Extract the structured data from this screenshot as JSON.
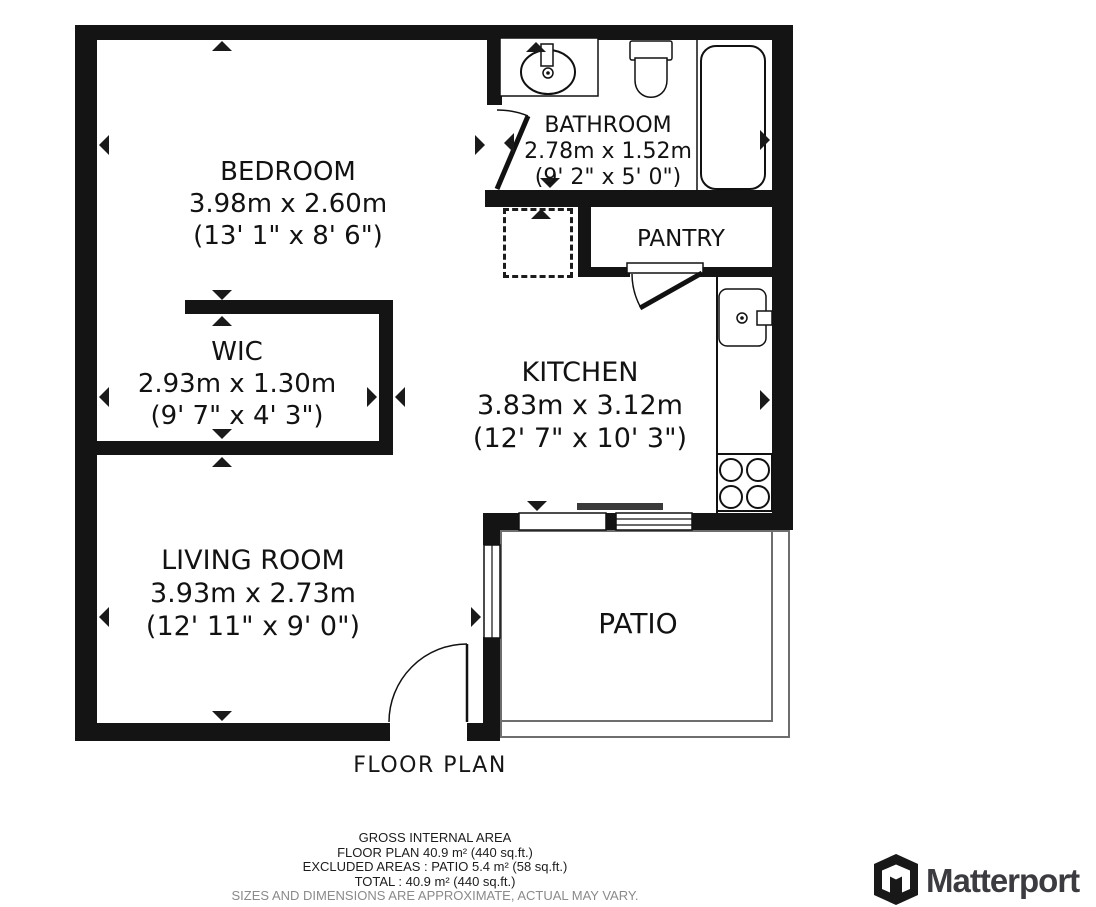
{
  "title": "FLOOR PLAN",
  "rooms": {
    "bedroom": {
      "name": "BEDROOM",
      "metric": "3.98m x 2.60m",
      "imperial": "(13' 1\" x 8' 6\")"
    },
    "bathroom": {
      "name": "BATHROOM",
      "metric": "2.78m x 1.52m",
      "imperial": "(9' 2\" x 5' 0\")"
    },
    "pantry": {
      "name": "PANTRY"
    },
    "wic": {
      "name": "WIC",
      "metric": "2.93m x 1.30m",
      "imperial": "(9' 7\" x 4' 3\")"
    },
    "kitchen": {
      "name": "KITCHEN",
      "metric": "3.83m x 3.12m",
      "imperial": "(12' 7\" x 10' 3\")"
    },
    "living_room": {
      "name": "LIVING ROOM",
      "metric": "3.93m x 2.73m",
      "imperial": "(12' 11\" x 9' 0\")"
    },
    "patio": {
      "name": "PATIO"
    }
  },
  "footer": {
    "line1": "GROSS INTERNAL AREA",
    "line2": "FLOOR PLAN 40.9 m² (440 sq.ft.)",
    "line3": "EXCLUDED AREAS :  PATIO 5.4 m² (58 sq.ft.)",
    "line4": "TOTAL :  40.9 m² (440 sq.ft.)",
    "disclaimer": "SIZES AND DIMENSIONS ARE APPROXIMATE, ACTUAL MAY VARY."
  },
  "branding": {
    "logo_text": "Matterport"
  },
  "colors": {
    "wall": "#141414",
    "text": "#121212",
    "disclaimer": "#8a8a8a",
    "logo_text": "#3b3b40",
    "sliding_door_bar": "#3a3a3a",
    "patio_border": "#6e6e6e"
  }
}
